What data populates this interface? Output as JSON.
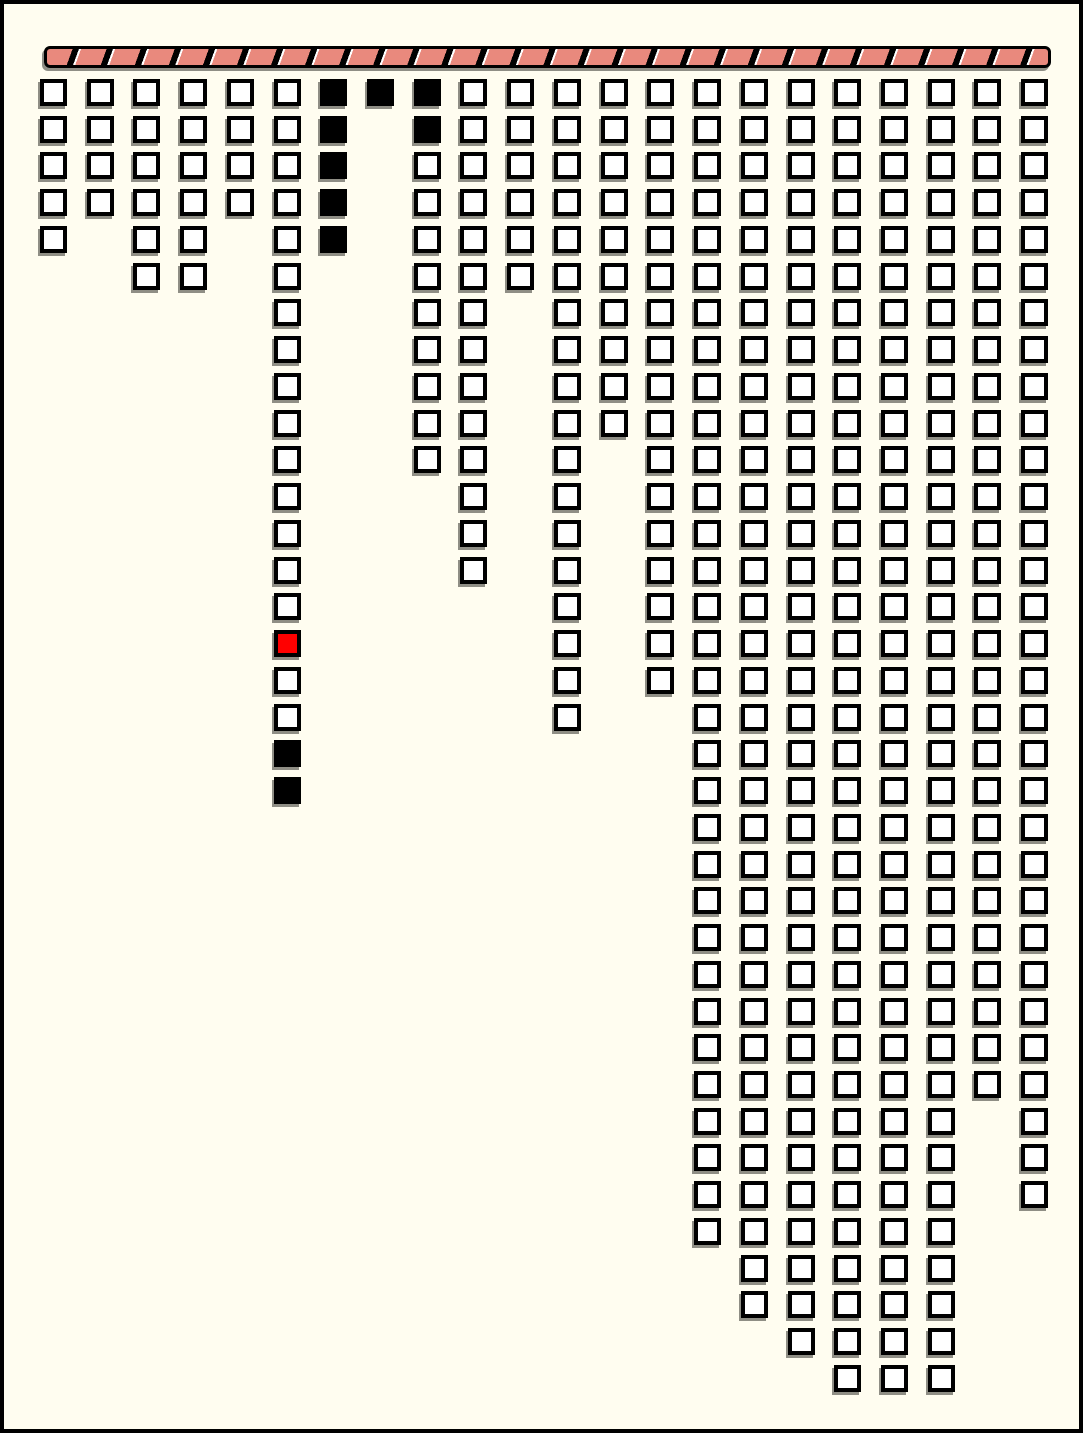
{
  "board": {
    "description": "Grid of outlined square boxes arranged in 22 columns of varying length hanging below a hatched header bar",
    "columns_count": 22,
    "max_rows": 36
  },
  "colors": {
    "background": "#fffdf0",
    "outline": "#000000",
    "cell_fill": "#ffffff",
    "filled_black": "#000000",
    "marker_red": "#ff0000",
    "bar_salmon": "#e9897d",
    "bar_divider": "#000000",
    "bar_sliver": "#ffffff",
    "shadow": "#8f8e85"
  },
  "header_bar": {
    "style": "salmon ribbon with diagonal black slash dividers and white slivers",
    "segments": 31
  },
  "chart_data": {
    "type": "heatmap",
    "title": "",
    "xlabel": "",
    "ylabel": "",
    "legend": {
      "white": "empty outlined box",
      "black": "filled box",
      "red": "highlighted box"
    },
    "columns": [
      {
        "col": 1,
        "cells": 5,
        "fills": {}
      },
      {
        "col": 2,
        "cells": 4,
        "fills": {}
      },
      {
        "col": 3,
        "cells": 6,
        "fills": {}
      },
      {
        "col": 4,
        "cells": 6,
        "fills": {}
      },
      {
        "col": 5,
        "cells": 4,
        "fills": {}
      },
      {
        "col": 6,
        "cells": 20,
        "fills": {
          "16": "red",
          "19": "black",
          "20": "black"
        }
      },
      {
        "col": 7,
        "cells": 5,
        "fills": {
          "1": "black",
          "2": "black",
          "3": "black",
          "4": "black",
          "5": "black"
        }
      },
      {
        "col": 8,
        "cells": 1,
        "fills": {
          "1": "black"
        }
      },
      {
        "col": 9,
        "cells": 11,
        "fills": {
          "1": "black",
          "2": "black"
        }
      },
      {
        "col": 10,
        "cells": 14,
        "fills": {}
      },
      {
        "col": 11,
        "cells": 6,
        "fills": {}
      },
      {
        "col": 12,
        "cells": 18,
        "fills": {}
      },
      {
        "col": 13,
        "cells": 10,
        "fills": {}
      },
      {
        "col": 14,
        "cells": 17,
        "fills": {}
      },
      {
        "col": 15,
        "cells": 32,
        "fills": {}
      },
      {
        "col": 16,
        "cells": 34,
        "fills": {}
      },
      {
        "col": 17,
        "cells": 35,
        "fills": {}
      },
      {
        "col": 18,
        "cells": 36,
        "fills": {}
      },
      {
        "col": 19,
        "cells": 36,
        "fills": {}
      },
      {
        "col": 20,
        "cells": 36,
        "fills": {}
      },
      {
        "col": 21,
        "cells": 28,
        "fills": {}
      },
      {
        "col": 22,
        "cells": 31,
        "fills": {}
      }
    ]
  }
}
